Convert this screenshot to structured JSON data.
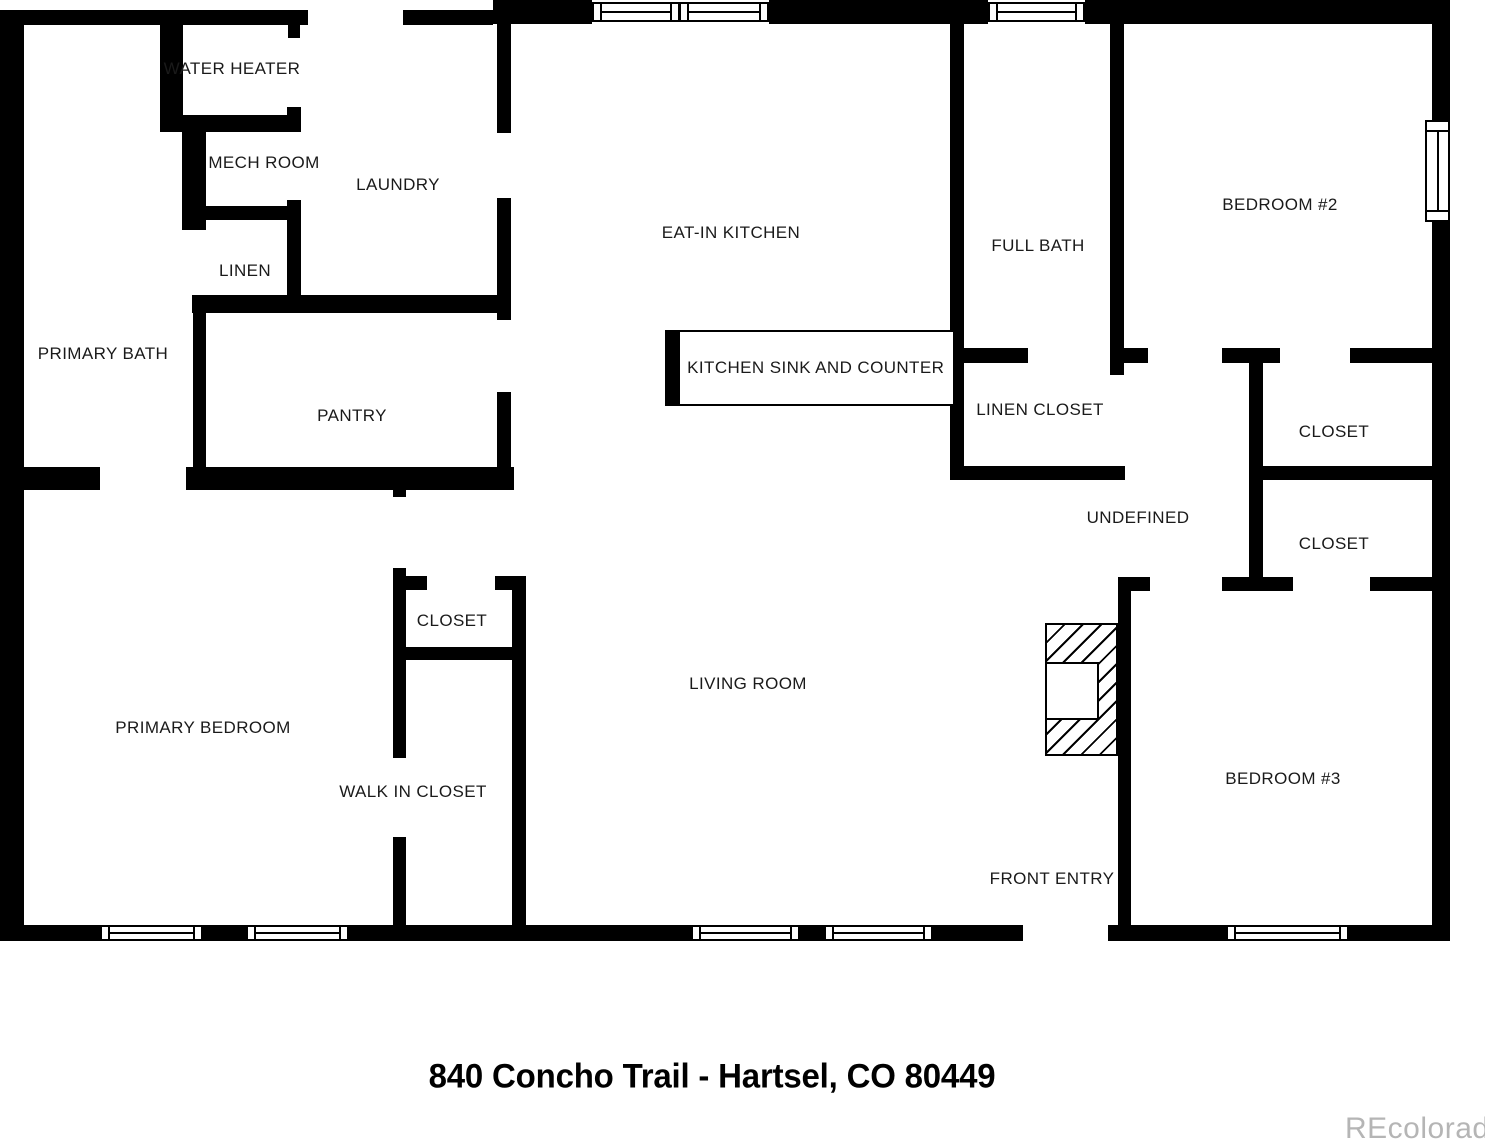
{
  "title": "840 Concho Trail - Hartsel, CO 80449",
  "watermark": "REcolorado",
  "colors": {
    "wall": "#000000",
    "background": "#ffffff",
    "label": "#1a1a1a",
    "watermark": "#b5b5b5"
  },
  "floorplan": {
    "rooms": [
      {
        "id": "water-heater",
        "label": "WATER HEATER",
        "x": 232,
        "y": 69
      },
      {
        "id": "mech-room",
        "label": "MECH ROOM",
        "x": 264,
        "y": 163
      },
      {
        "id": "laundry",
        "label": "LAUNDRY",
        "x": 398,
        "y": 185
      },
      {
        "id": "linen",
        "label": "LINEN",
        "x": 245,
        "y": 271
      },
      {
        "id": "primary-bath",
        "label": "PRIMARY BATH",
        "x": 103,
        "y": 354
      },
      {
        "id": "pantry",
        "label": "PANTRY",
        "x": 352,
        "y": 416
      },
      {
        "id": "eat-in-kitchen",
        "label": "EAT-IN KITCHEN",
        "x": 731,
        "y": 233
      },
      {
        "id": "full-bath",
        "label": "FULL BATH",
        "x": 1038,
        "y": 246
      },
      {
        "id": "bedroom-2",
        "label": "BEDROOM #2",
        "x": 1280,
        "y": 205
      },
      {
        "id": "linen-closet",
        "label": "LINEN CLOSET",
        "x": 1040,
        "y": 410
      },
      {
        "id": "closet-bedroom2",
        "label": "CLOSET",
        "x": 1334,
        "y": 432
      },
      {
        "id": "undefined-room",
        "label": "UNDEFINED",
        "x": 1138,
        "y": 518
      },
      {
        "id": "closet-bedroom3",
        "label": "CLOSET",
        "x": 1334,
        "y": 544
      },
      {
        "id": "closet-primary",
        "label": "CLOSET",
        "x": 452,
        "y": 621
      },
      {
        "id": "living-room",
        "label": "LIVING ROOM",
        "x": 748,
        "y": 684
      },
      {
        "id": "primary-bedroom",
        "label": "PRIMARY BEDROOM",
        "x": 203,
        "y": 728
      },
      {
        "id": "bedroom-3",
        "label": "BEDROOM #3",
        "x": 1283,
        "y": 779
      },
      {
        "id": "walk-in-closet",
        "label": "WALK IN CLOSET",
        "x": 413,
        "y": 792
      },
      {
        "id": "front-entry",
        "label": "FRONT ENTRY",
        "x": 1052,
        "y": 879
      }
    ],
    "counter": {
      "label": "KITCHEN SINK AND COUNTER",
      "x": 665,
      "y": 330,
      "w": 290,
      "h": 76,
      "cap_w": 13
    },
    "fireplace": {
      "x": 1045,
      "y": 623,
      "w": 73,
      "h": 133,
      "inner": {
        "dx": 0,
        "dy": 39,
        "w": 54,
        "h": 58
      }
    },
    "walls": [
      [
        0,
        10,
        308,
        15
      ],
      [
        403,
        10,
        90,
        15
      ],
      [
        493,
        0,
        99,
        24
      ],
      [
        769,
        0,
        219,
        24
      ],
      [
        1085,
        0,
        365,
        24
      ],
      [
        0,
        10,
        24,
        931
      ],
      [
        24,
        925,
        76,
        16
      ],
      [
        203,
        925,
        43,
        16
      ],
      [
        349,
        925,
        342,
        16
      ],
      [
        800,
        925,
        24,
        16
      ],
      [
        933,
        925,
        90,
        16
      ],
      [
        1108,
        925,
        118,
        16
      ],
      [
        1349,
        925,
        101,
        16
      ],
      [
        1432,
        0,
        18,
        120
      ],
      [
        1432,
        222,
        18,
        719
      ],
      [
        160,
        25,
        23,
        107
      ],
      [
        160,
        115,
        141,
        17
      ],
      [
        288,
        24,
        12,
        14
      ],
      [
        287,
        107,
        14,
        25
      ],
      [
        287,
        200,
        14,
        113
      ],
      [
        182,
        132,
        24,
        98
      ],
      [
        206,
        206,
        95,
        14
      ],
      [
        192,
        295,
        109,
        18
      ],
      [
        193,
        313,
        13,
        176
      ],
      [
        193,
        295,
        318,
        18
      ],
      [
        497,
        24,
        14,
        109
      ],
      [
        497,
        198,
        14,
        122
      ],
      [
        497,
        392,
        14,
        98
      ],
      [
        24,
        467,
        76,
        23
      ],
      [
        186,
        467,
        328,
        23
      ],
      [
        393,
        482,
        13,
        15
      ],
      [
        393,
        568,
        13,
        190
      ],
      [
        393,
        837,
        13,
        104
      ],
      [
        405,
        576,
        22,
        14
      ],
      [
        495,
        576,
        17,
        14
      ],
      [
        512,
        576,
        14,
        365
      ],
      [
        405,
        647,
        107,
        13
      ],
      [
        950,
        24,
        14,
        456
      ],
      [
        1110,
        24,
        14,
        351
      ],
      [
        950,
        348,
        78,
        15
      ],
      [
        1110,
        348,
        38,
        15
      ],
      [
        1222,
        348,
        58,
        15
      ],
      [
        1350,
        348,
        86,
        15
      ],
      [
        950,
        466,
        175,
        14
      ],
      [
        1249,
        363,
        14,
        227
      ],
      [
        1263,
        466,
        173,
        14
      ],
      [
        1118,
        577,
        32,
        14
      ],
      [
        1222,
        577,
        71,
        14
      ],
      [
        1370,
        577,
        66,
        14
      ],
      [
        1118,
        577,
        13,
        364
      ]
    ],
    "windows": [
      {
        "type": "h",
        "x": 592,
        "y": 2,
        "w": 88,
        "h": 20
      },
      {
        "type": "h",
        "x": 679,
        "y": 2,
        "w": 90,
        "h": 20
      },
      {
        "type": "h",
        "x": 988,
        "y": 2,
        "w": 97,
        "h": 20
      },
      {
        "type": "h",
        "x": 100,
        "y": 925,
        "w": 103,
        "h": 16
      },
      {
        "type": "h",
        "x": 246,
        "y": 925,
        "w": 103,
        "h": 16
      },
      {
        "type": "h",
        "x": 691,
        "y": 925,
        "w": 109,
        "h": 16
      },
      {
        "type": "h",
        "x": 824,
        "y": 925,
        "w": 109,
        "h": 16
      },
      {
        "type": "h",
        "x": 1226,
        "y": 925,
        "w": 123,
        "h": 16
      },
      {
        "type": "v",
        "x": 1425,
        "y": 120,
        "w": 25,
        "h": 102
      }
    ]
  }
}
